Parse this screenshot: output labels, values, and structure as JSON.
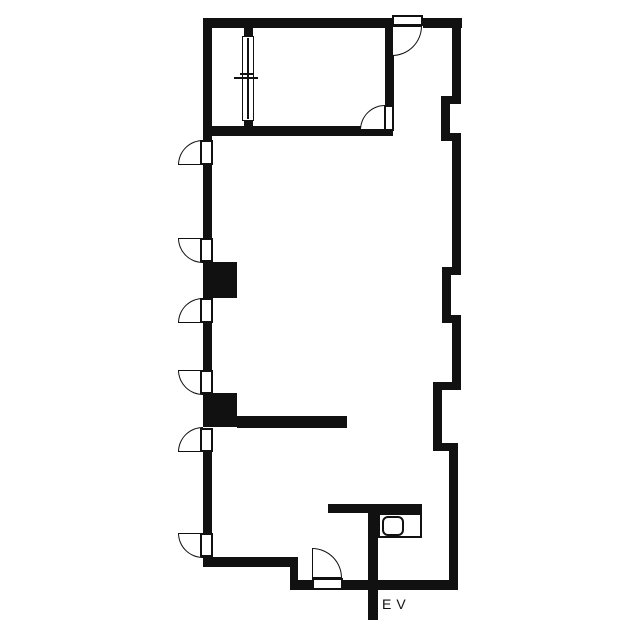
{
  "colors": {
    "ink": "#111111",
    "background": "#ffffff"
  },
  "labels": {
    "elevator": "EV"
  },
  "plan": {
    "walls": [
      {
        "name": "top-wall-left",
        "x": 203,
        "y": 18,
        "w": 189,
        "h": 10
      },
      {
        "name": "top-wall-right",
        "x": 423,
        "y": 18,
        "w": 39,
        "h": 10
      },
      {
        "name": "left-wall-top",
        "x": 203,
        "y": 18,
        "w": 9,
        "h": 122
      },
      {
        "name": "window-wall-stub-top",
        "x": 244,
        "y": 28,
        "w": 9,
        "h": 10
      },
      {
        "name": "window-wall-stub-bottom",
        "x": 244,
        "y": 118,
        "w": 9,
        "h": 18
      },
      {
        "name": "room-bottom-wall",
        "x": 203,
        "y": 126,
        "w": 190,
        "h": 10
      },
      {
        "name": "room-right-wall",
        "x": 385,
        "y": 28,
        "w": 9,
        "h": 77
      },
      {
        "name": "left-wall-2",
        "x": 203,
        "y": 165,
        "w": 9,
        "h": 73
      },
      {
        "name": "left-wall-3",
        "x": 203,
        "y": 323,
        "w": 9,
        "h": 47
      },
      {
        "name": "left-wall-4",
        "x": 203,
        "y": 452,
        "w": 9,
        "h": 81
      },
      {
        "name": "bottom-wall-upper",
        "x": 203,
        "y": 557,
        "w": 95,
        "h": 10
      },
      {
        "name": "bottom-step-connector",
        "x": 290,
        "y": 557,
        "w": 8,
        "h": 33
      },
      {
        "name": "bottom-wall-lower-left",
        "x": 298,
        "y": 580,
        "w": 14,
        "h": 10
      },
      {
        "name": "bottom-wall-lower-right",
        "x": 343,
        "y": 580,
        "w": 115,
        "h": 10
      },
      {
        "name": "interior-partition-wall",
        "x": 237,
        "y": 416,
        "w": 110,
        "h": 12
      },
      {
        "name": "elevator-shaft-wall",
        "x": 368,
        "y": 504,
        "w": 10,
        "h": 116
      },
      {
        "name": "elevator-counter-wall",
        "x": 328,
        "y": 504,
        "w": 94,
        "h": 9
      },
      {
        "name": "right-wall-1",
        "x": 452,
        "y": 18,
        "w": 9,
        "h": 86
      },
      {
        "name": "right-wall-step-1",
        "x": 441,
        "y": 96,
        "w": 20,
        "h": 8
      },
      {
        "name": "right-wall-2",
        "x": 441,
        "y": 96,
        "w": 9,
        "h": 45
      },
      {
        "name": "right-wall-step-2",
        "x": 441,
        "y": 133,
        "w": 20,
        "h": 8
      },
      {
        "name": "right-wall-3",
        "x": 452,
        "y": 133,
        "w": 9,
        "h": 142
      },
      {
        "name": "right-wall-step-3",
        "x": 442,
        "y": 267,
        "w": 19,
        "h": 8
      },
      {
        "name": "right-wall-4",
        "x": 442,
        "y": 267,
        "w": 9,
        "h": 56
      },
      {
        "name": "right-wall-step-4",
        "x": 442,
        "y": 315,
        "w": 19,
        "h": 8
      },
      {
        "name": "right-wall-5",
        "x": 452,
        "y": 315,
        "w": 9,
        "h": 75
      },
      {
        "name": "right-wall-step-5",
        "x": 433,
        "y": 382,
        "w": 28,
        "h": 8
      },
      {
        "name": "right-wall-6",
        "x": 433,
        "y": 382,
        "w": 9,
        "h": 69
      },
      {
        "name": "right-wall-step-6",
        "x": 433,
        "y": 443,
        "w": 25,
        "h": 8
      },
      {
        "name": "right-wall-7",
        "x": 449,
        "y": 443,
        "w": 9,
        "h": 147
      }
    ],
    "pillars": [
      {
        "name": "pillar-1",
        "x": 203,
        "y": 262,
        "w": 34,
        "h": 36
      },
      {
        "name": "pillar-2",
        "x": 203,
        "y": 393,
        "w": 34,
        "h": 34
      }
    ],
    "doors": [
      {
        "name": "door-1",
        "leaf": {
          "x": 200,
          "y": 140,
          "w": 13,
          "h": 25
        },
        "swing": {
          "x": 178,
          "y": 140,
          "r": 25,
          "corner": "tl"
        }
      },
      {
        "name": "door-2",
        "leaf": {
          "x": 200,
          "y": 238,
          "w": 13,
          "h": 24
        },
        "swing": {
          "x": 178,
          "y": 238,
          "r": 25,
          "corner": "bl"
        }
      },
      {
        "name": "door-3",
        "leaf": {
          "x": 200,
          "y": 298,
          "w": 13,
          "h": 25
        },
        "swing": {
          "x": 178,
          "y": 298,
          "r": 25,
          "corner": "tl"
        }
      },
      {
        "name": "door-4",
        "leaf": {
          "x": 200,
          "y": 370,
          "w": 13,
          "h": 24
        },
        "swing": {
          "x": 178,
          "y": 370,
          "r": 25,
          "corner": "bl"
        }
      },
      {
        "name": "door-5",
        "leaf": {
          "x": 200,
          "y": 428,
          "w": 13,
          "h": 24
        },
        "swing": {
          "x": 178,
          "y": 427,
          "r": 25,
          "corner": "tl"
        }
      },
      {
        "name": "door-6",
        "leaf": {
          "x": 200,
          "y": 533,
          "w": 13,
          "h": 24
        },
        "swing": {
          "x": 178,
          "y": 533,
          "r": 25,
          "corner": "bl"
        }
      },
      {
        "name": "door-7-top-entry",
        "leaf": {
          "x": 392,
          "y": 15,
          "w": 31,
          "h": 11
        },
        "swing": {
          "x": 392,
          "y": 26,
          "r": 30,
          "corner": "br"
        }
      },
      {
        "name": "door-8-room",
        "leaf": {
          "x": 384,
          "y": 105,
          "w": 10,
          "h": 26
        },
        "swing": {
          "x": 360,
          "y": 105,
          "r": 25,
          "corner": "tl"
        }
      },
      {
        "name": "door-9-bottom-entry",
        "leaf": {
          "x": 312,
          "y": 578,
          "w": 31,
          "h": 12
        },
        "swing": {
          "x": 312,
          "y": 548,
          "r": 30,
          "corner": "tr"
        }
      }
    ],
    "window": {
      "frame": {
        "x": 242,
        "y": 36,
        "w": 12,
        "h": 85
      },
      "mullion": {
        "x": 247,
        "y": 38,
        "w": 2,
        "h": 81
      },
      "ticks": [
        {
          "x": 234,
          "y": 77,
          "w": 24,
          "h": 2
        },
        {
          "x": 240,
          "y": 73,
          "w": 13,
          "h": 2
        }
      ]
    },
    "elevator_fixture": {
      "outer": {
        "x": 378,
        "y": 513,
        "w": 44,
        "h": 25
      },
      "inner": {
        "x": 382,
        "y": 516,
        "w": 22,
        "h": 20
      }
    },
    "label_positions": {
      "ev": {
        "x": 382,
        "y": 597
      }
    }
  }
}
